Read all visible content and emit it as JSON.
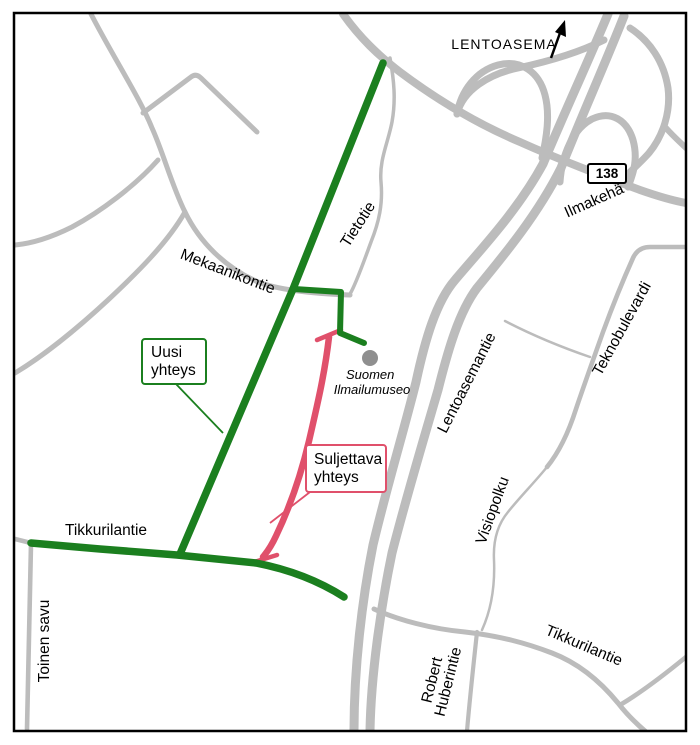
{
  "map": {
    "colors": {
      "background": "#ffffff",
      "road": "#bcbcbc",
      "route_new": "#1b7f1f",
      "route_closed": "#e0506b",
      "museum_dot": "#8f8f8f",
      "text": "#000000",
      "border": "#000000"
    },
    "direction_sign": {
      "label": "LENTOASEMA"
    },
    "road_badge": {
      "number": "138"
    },
    "roads": {
      "ilmakeha": "Ilmakehä",
      "tietotie": "Tietotie",
      "mekaanikontie": "Mekaanikontie",
      "lentoasemantie": "Lentoasemantie",
      "teknobulevardi": "Teknobulevardi",
      "visiopolku": "Visiopolku",
      "tikkurilantie_west": "Tikkurilantie",
      "tikkurilantie_east": "Tikkurilantie",
      "toinen_savu": "Toinen savu",
      "robert_huberintie_line1": "Robert",
      "robert_huberintie_line2": "Huberintie"
    },
    "poi": {
      "museum_line1": "Suomen",
      "museum_line2": "Ilmailumuseo"
    },
    "callouts": {
      "new_connection": {
        "line1": "Uusi",
        "line2": "yhteys"
      },
      "closed_connection": {
        "line1": "Suljettava",
        "line2": "yhteys"
      }
    }
  }
}
